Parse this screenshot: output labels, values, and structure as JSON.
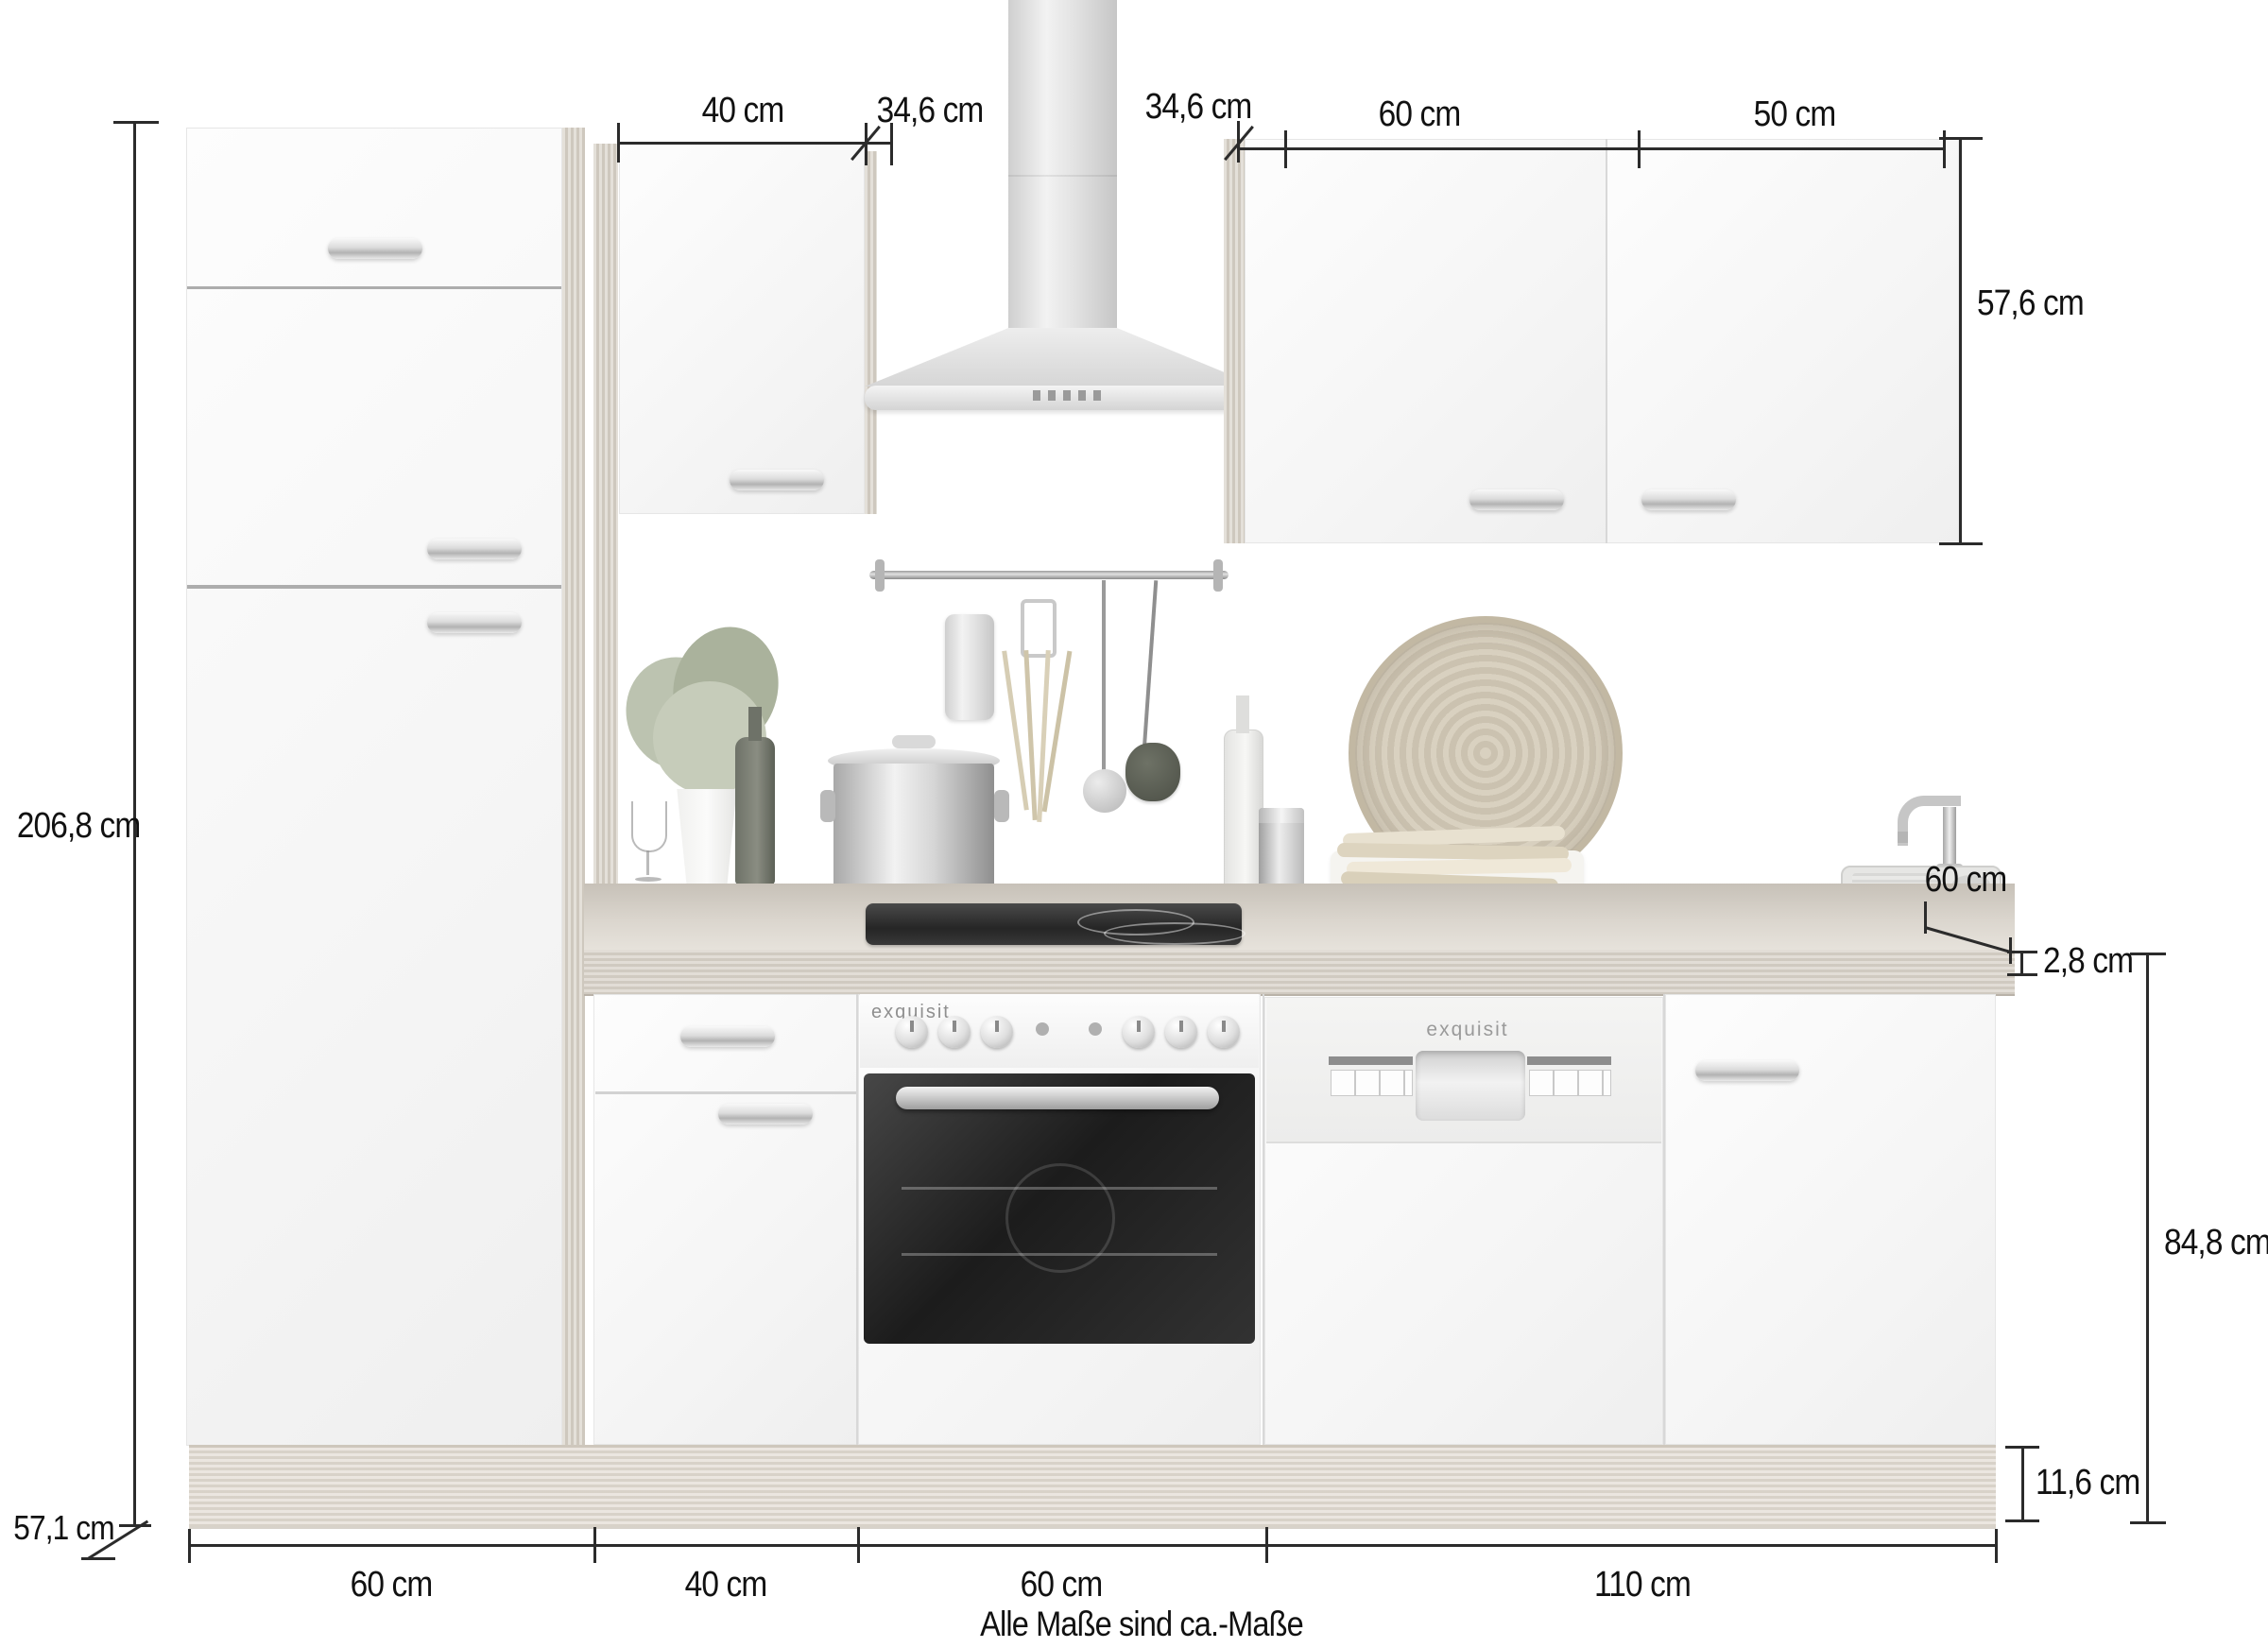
{
  "labels": {
    "top_40": "40 cm",
    "top_346_left": "34,6 cm",
    "top_346_right": "34,6 cm",
    "top_60": "60 cm",
    "top_50": "50 cm",
    "right_576": "57,6 cm",
    "right_60": "60 cm",
    "right_28": "2,8 cm",
    "right_848": "84,8 cm",
    "right_116": "11,6 cm",
    "left_2068": "206,8 cm",
    "left_571": "57,1 cm",
    "bottom_60a": "60 cm",
    "bottom_40": "40 cm",
    "bottom_60b": "60 cm",
    "bottom_110": "110 cm",
    "footnote": "Alle Maße sind ca.-Maße"
  },
  "appliances": {
    "oven_brand": "exquisit",
    "dishwasher_brand": "exquisit"
  },
  "colors": {
    "line": "#2b2b2b",
    "text": "#111111",
    "wood": "#d8d2c9",
    "cabinet": "#fafafa",
    "appliance_dark": "#2f2f2f"
  }
}
